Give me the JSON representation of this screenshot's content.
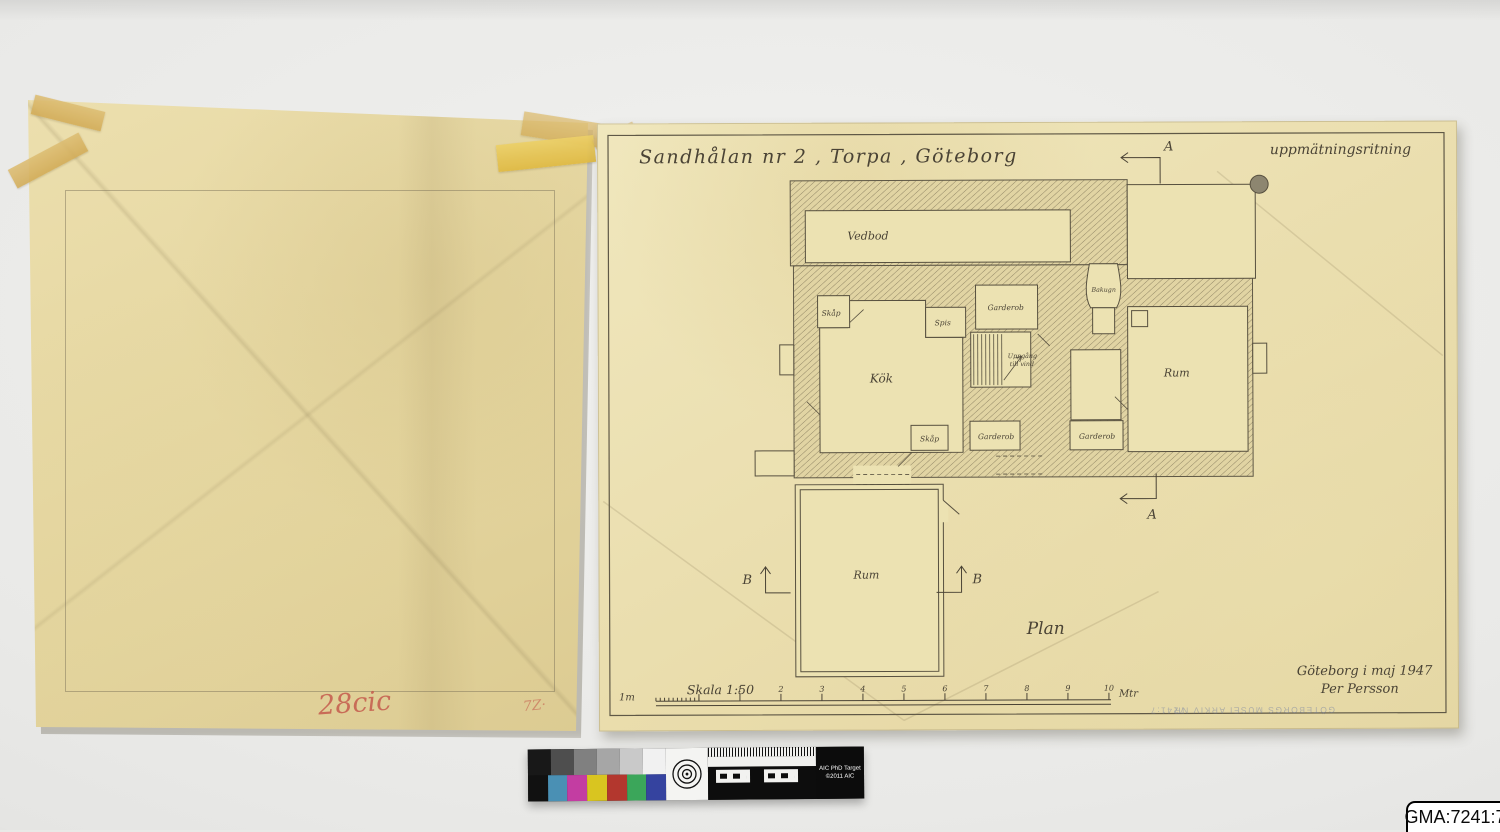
{
  "photo": {
    "archive_label": "GMA:7241:7"
  },
  "left_sheet": {
    "red_note": "28cic",
    "red_note_small": "7Z·"
  },
  "plan_sheet": {
    "title": "Sandhålan  nr 2  ,  Torpa ,  Göteborg",
    "annotation_top_right": "uppmätningsritning",
    "plan_caption": "Plan",
    "rooms": {
      "vedbod": "Vedbod",
      "kok": "Kök",
      "spis": "Spis",
      "skap_1": "Skåp",
      "skap_2": "Skåp",
      "garderob_1": "Garderob",
      "garderob_2": "Garderob",
      "garderob_3": "Garderob",
      "bakugn": "Bakugn",
      "rum_1": "Rum",
      "rum_2": "Rum"
    },
    "stairs_label_1": "Uppgång",
    "stairs_label_2": "till vind",
    "section_markers": {
      "a": "A",
      "b": "B"
    },
    "scale": {
      "label": "Skala  1:50",
      "left_unit": "1m",
      "right_unit": "Mtr",
      "ticks": [
        "1",
        "2",
        "3",
        "4",
        "5",
        "6",
        "7",
        "8",
        "9",
        "10"
      ]
    },
    "date_line": "Göteborg i maj 1947",
    "signature": "Per Persson",
    "stamp": {
      "text": "GÖTEBORGS MUSEI ARKIV NR",
      "number": "7241:7"
    }
  },
  "color_target": {
    "name": "AIC PhD Target",
    "copyright": "©2011 AIC",
    "gray_patches": [
      "#181818",
      "#4e4e4e",
      "#808080",
      "#a6a6a6",
      "#c9c9c9",
      "#f1f1f1"
    ],
    "color_patches": [
      "#111111",
      "#4a90b4",
      "#c33da2",
      "#d9c520",
      "#b3372e",
      "#3ba65a",
      "#35439f"
    ]
  },
  "colors": {
    "paper_left": "#e4d59e",
    "paper_right": "#e9dcab",
    "ink": "#57503f",
    "red_annotation": "#c4574a"
  }
}
